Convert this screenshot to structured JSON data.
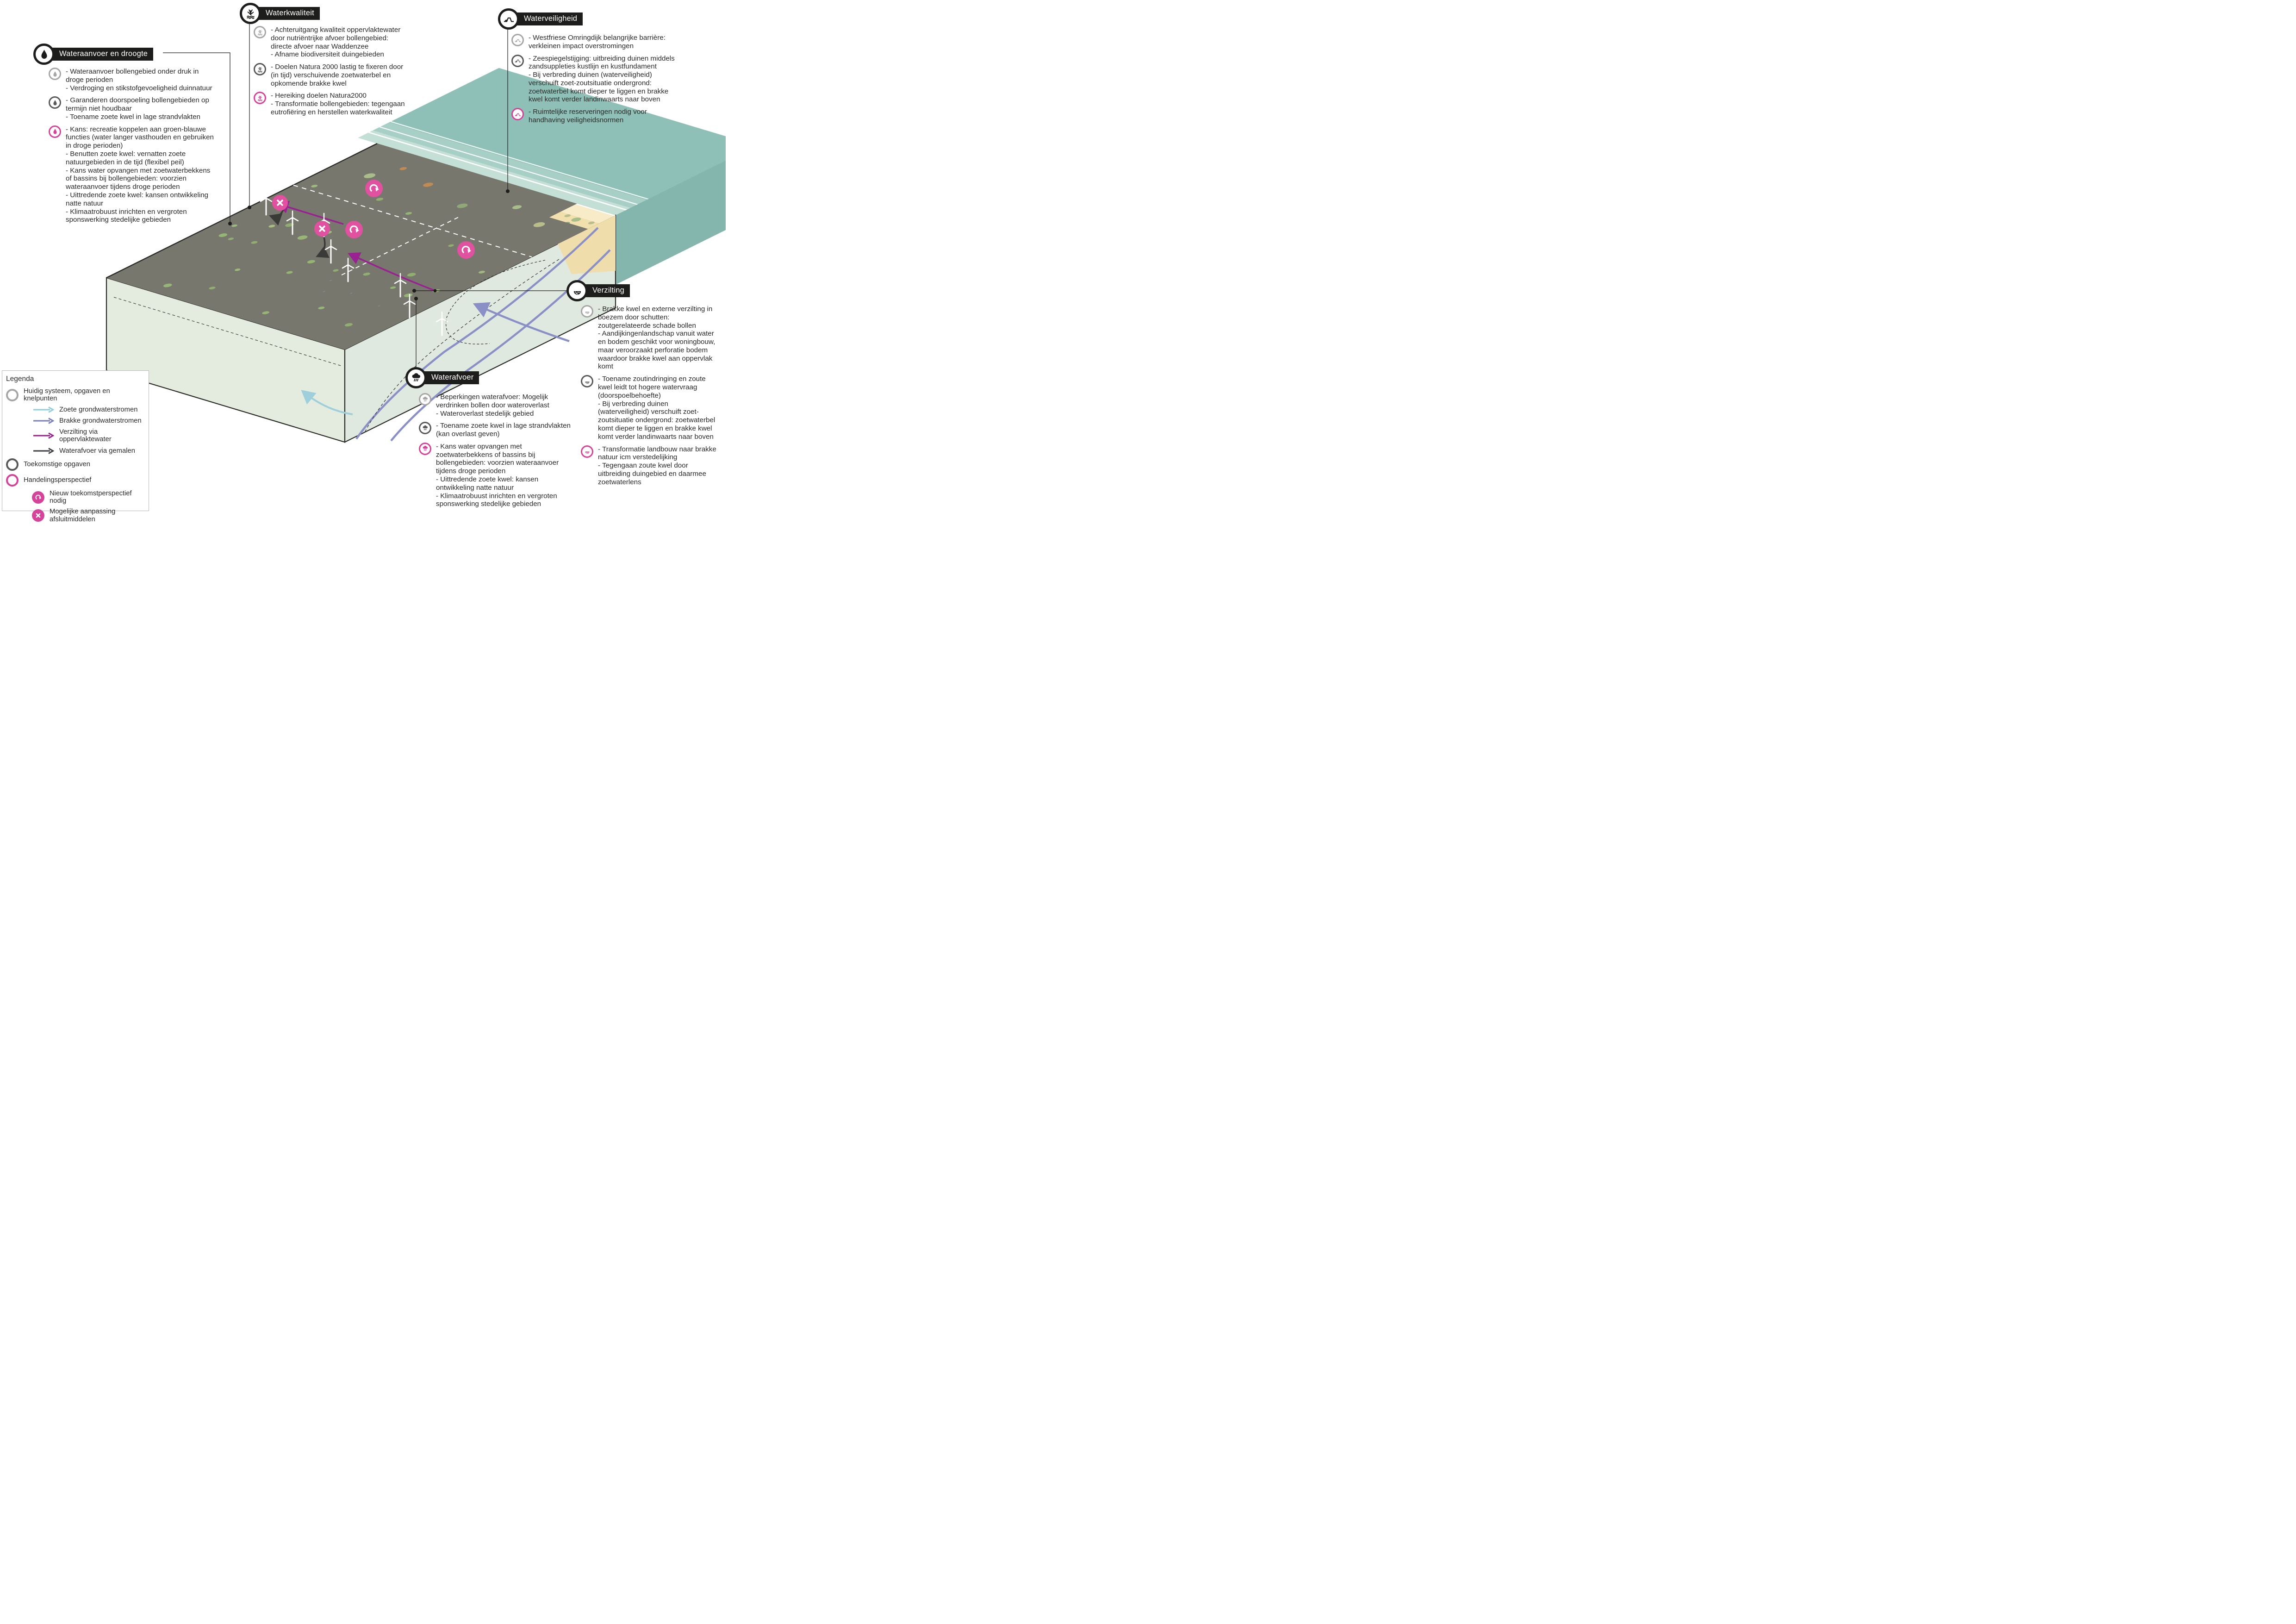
{
  "topics": [
    {
      "id": "wateraanvoer",
      "title": "Wateraanvoer en droogte",
      "icon": "droplet-icon",
      "items": [
        {
          "level": "huidig-systeem",
          "text": "- Wateraanvoer bollengebied onder druk in droge perioden\n- Verdroging en stikstofgevoeligheid duinnatuur"
        },
        {
          "level": "toekomstige-opgaven",
          "text": "- Garanderen doorspoeling bollengebieden op termijn niet houdbaar\n- Toename zoete kwel in lage strandvlakten"
        },
        {
          "level": "handelingsperspectief",
          "text": "- Kans: recreatie koppelen aan groen-blauwe functies (water langer vasthouden en gebruiken in droge perioden)\n- Benutten zoete kwel: vernatten zoete natuurgebieden in de tijd (flexibel peil)\n- Kans water opvangen met zoetwaterbekkens of bassins bij bollengebieden: voorzien wateraanvoer tijdens droge perioden\n- Uittredende zoete kwel: kansen ontwikkeling natte natuur\n- Klimaatrobuust inrichten en vergroten sponswerking stedelijke gebieden"
        }
      ]
    },
    {
      "id": "waterkwaliteit",
      "title": "Waterkwaliteit",
      "icon": "reed-icon",
      "items": [
        {
          "level": "huidig-systeem",
          "text": "- Achteruitgang kwaliteit oppervlaktewater door nutriëntrijke afvoer bollengebied: directe afvoer naar Waddenzee\n- Afname biodiversiteit duingebieden"
        },
        {
          "level": "toekomstige-opgaven",
          "text": "- Doelen Natura 2000 lastig te fixeren door (in tijd) verschuivende zoetwaterbel en opkomende brakke kwel"
        },
        {
          "level": "handelingsperspectief",
          "text": "- Hereiking doelen Natura2000\n- Transformatie bollengebieden: tegengaan eutrofiëring en herstellen waterkwaliteit"
        }
      ]
    },
    {
      "id": "waterveiligheid",
      "title": "Waterveiligheid",
      "icon": "dike-icon",
      "items": [
        {
          "level": "huidig-systeem",
          "text": "- Westfriese Omringdijk belangrijke barrière: verkleinen impact overstromingen"
        },
        {
          "level": "toekomstige-opgaven",
          "text": "- Zeespiegelstijging: uitbreiding duinen middels zandsuppleties kustlijn en kustfundament\n- Bij verbreding duinen (waterveiligheid) verschuift zoet-zoutsituatie ondergrond: zoetwaterbel komt dieper te liggen en brakke kwel komt verder landinwaarts naar boven"
        },
        {
          "level": "handelingsperspectief",
          "text": "- Ruimtelijke reserveringen nodig voor handhaving veiligheidsnormen"
        }
      ]
    },
    {
      "id": "verzilting",
      "title": "Verzilting",
      "icon": "salt-icon",
      "items": [
        {
          "level": "huidig-systeem",
          "text": "- Brakke kwel en externe verzilting in boezem door schutten: zoutgerelateerde schade bollen\n- Aandijkingenlandschap vanuit water en bodem geschikt voor woningbouw, maar veroorzaakt perforatie bodem waardoor brakke kwel aan oppervlak komt"
        },
        {
          "level": "toekomstige-opgaven",
          "text": "- Toename zoutindringing en zoute kwel leidt tot hogere watervraag (doorspoelbehoefte)\n- Bij verbreding duinen (waterveiligheid) verschuift zoet-zoutsituatie ondergrond: zoetwaterbel komt dieper te liggen en brakke kwel komt verder landinwaarts naar boven"
        },
        {
          "level": "handelingsperspectief",
          "text": "- Transformatie landbouw naar brakke natuur icm verstedelijking\n- Tegengaan zoute kwel door uitbreiding duingebied en daarmee zoetwaterlens"
        }
      ]
    },
    {
      "id": "waterafvoer",
      "title": "Waterafvoer",
      "icon": "raincloud-icon",
      "items": [
        {
          "level": "huidig-systeem",
          "text": "- Beperkingen waterafvoer: Mogelijk verdrinken bollen door wateroverlast\n- Wateroverlast stedelijk gebied"
        },
        {
          "level": "toekomstige-opgaven",
          "text": "- Toename zoete kwel in lage strandvlakten (kan overlast geven)"
        },
        {
          "level": "handelingsperspectief",
          "text": "- Kans water opvangen met zoetwaterbekkens of bassins bij bollengebieden: voorzien wateraanvoer tijdens droge perioden\n- Uittredende zoete kwel: kansen ontwikkeling natte natuur\n- Klimaatrobuust inrichten en vergroten sponswerking stedelijke gebieden"
        }
      ]
    }
  ],
  "legend": {
    "title": "Legenda",
    "rings": [
      {
        "id": "huidig-systeem",
        "label": "Huidig systeem, opgaven en knelpunten",
        "color": "#a7a5a6"
      },
      {
        "id": "toekomstige-opgaven",
        "label": "Toekomstige opgaven",
        "color": "#58595b"
      },
      {
        "id": "handelingsperspectief",
        "label": "Handelingsperspectief",
        "color": "#d6439a"
      }
    ],
    "arrows": [
      {
        "id": "zoete-grondwaterstromen",
        "label": "Zoete grondwaterstromen",
        "color": "#93cedd"
      },
      {
        "id": "brakke-grondwaterstromen",
        "label": "Brakke grondwaterstromen",
        "color": "#7a7dbf"
      },
      {
        "id": "verzilting-via-oppervlaktewater",
        "label": "Verzilting via oppervlaktewater",
        "color": "#9a2191"
      },
      {
        "id": "waterafvoer-via-gemalen",
        "label": "Waterafvoer via gemalen",
        "color": "#3d3d42"
      }
    ],
    "badges": [
      {
        "id": "nieuw-toekomstperspectief",
        "label": "Nieuw toekomstperspectief nodig",
        "glyph": "rotate-arrow",
        "color": "#d6439a"
      },
      {
        "id": "aanpassing-afsluitmiddelen",
        "label": "Mogelijke aanpassing afsluitmiddelen",
        "glyph": "cross",
        "color": "#d6439a"
      }
    ]
  },
  "map": {
    "markers": [
      {
        "glyph": "cross",
        "meaning": "mogelijke aanpassing afsluitmiddelen"
      },
      {
        "glyph": "cross",
        "meaning": "mogelijke aanpassing afsluitmiddelen"
      },
      {
        "glyph": "rotate-arrow",
        "meaning": "nieuw toekomstperspectief nodig"
      },
      {
        "glyph": "rotate-arrow",
        "meaning": "nieuw toekomstperspectief nodig"
      },
      {
        "glyph": "rotate-arrow",
        "meaning": "nieuw toekomstperspectief nodig"
      }
    ],
    "colors": {
      "sea": "#8fc0b7",
      "beach": "#f8ecc8",
      "dunes": "#f2dfae",
      "polder": "#d6dfa3",
      "canal": "#c4e3e6",
      "bulb_red": "#ec8677",
      "bulb_orange": "#f1ac60",
      "bulb_yellow": "#ead76c",
      "bulb_mauve": "#b7a5bf",
      "marker_pink": "#e0519f"
    }
  }
}
